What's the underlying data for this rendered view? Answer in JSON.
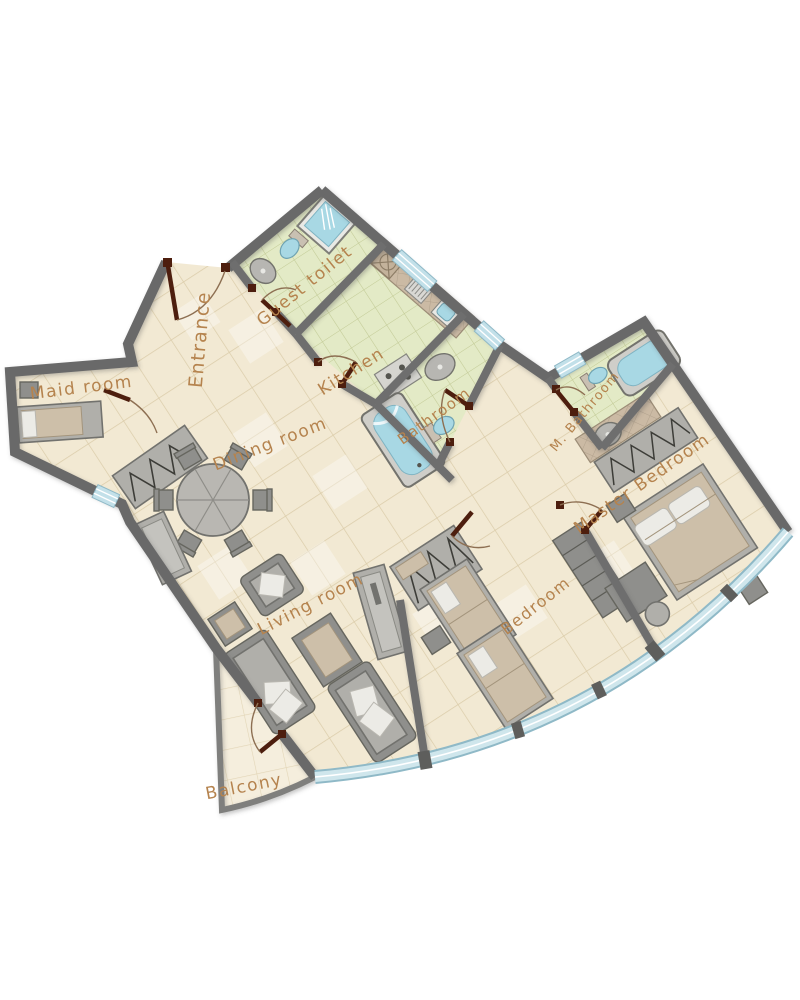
{
  "plan": {
    "rooms": [
      {
        "id": "entrance",
        "label": "Entrance"
      },
      {
        "id": "guest-toilet",
        "label": "Guest toilet"
      },
      {
        "id": "kitchen",
        "label": "Kitchen"
      },
      {
        "id": "maid-room",
        "label": "Maid room"
      },
      {
        "id": "dining-room",
        "label": "Dining room"
      },
      {
        "id": "bathroom",
        "label": "Bathroom"
      },
      {
        "id": "m-bathroom",
        "label": "M. Bathroom"
      },
      {
        "id": "master-bedroom",
        "label": "Master Bedroom"
      },
      {
        "id": "bedroom",
        "label": "Bedroom"
      },
      {
        "id": "living-room",
        "label": "Living room"
      },
      {
        "id": "balcony",
        "label": "Balcony"
      }
    ],
    "colors": {
      "wall": "#696969",
      "floor_tile": "#f2e9d3",
      "wet_room_tile": "#e3eac6",
      "counter_tile": "#cbbaa4",
      "window": "#c2e0e9",
      "curtain_wall": "#cfe6ec",
      "door_leaf": "#4d1e0e",
      "door_arc": "#8d6f52",
      "label_text": "#b5834e",
      "furniture": "#b0afaa",
      "water": "#a8d8e4",
      "balcony_floor": "#f5eedd"
    }
  }
}
